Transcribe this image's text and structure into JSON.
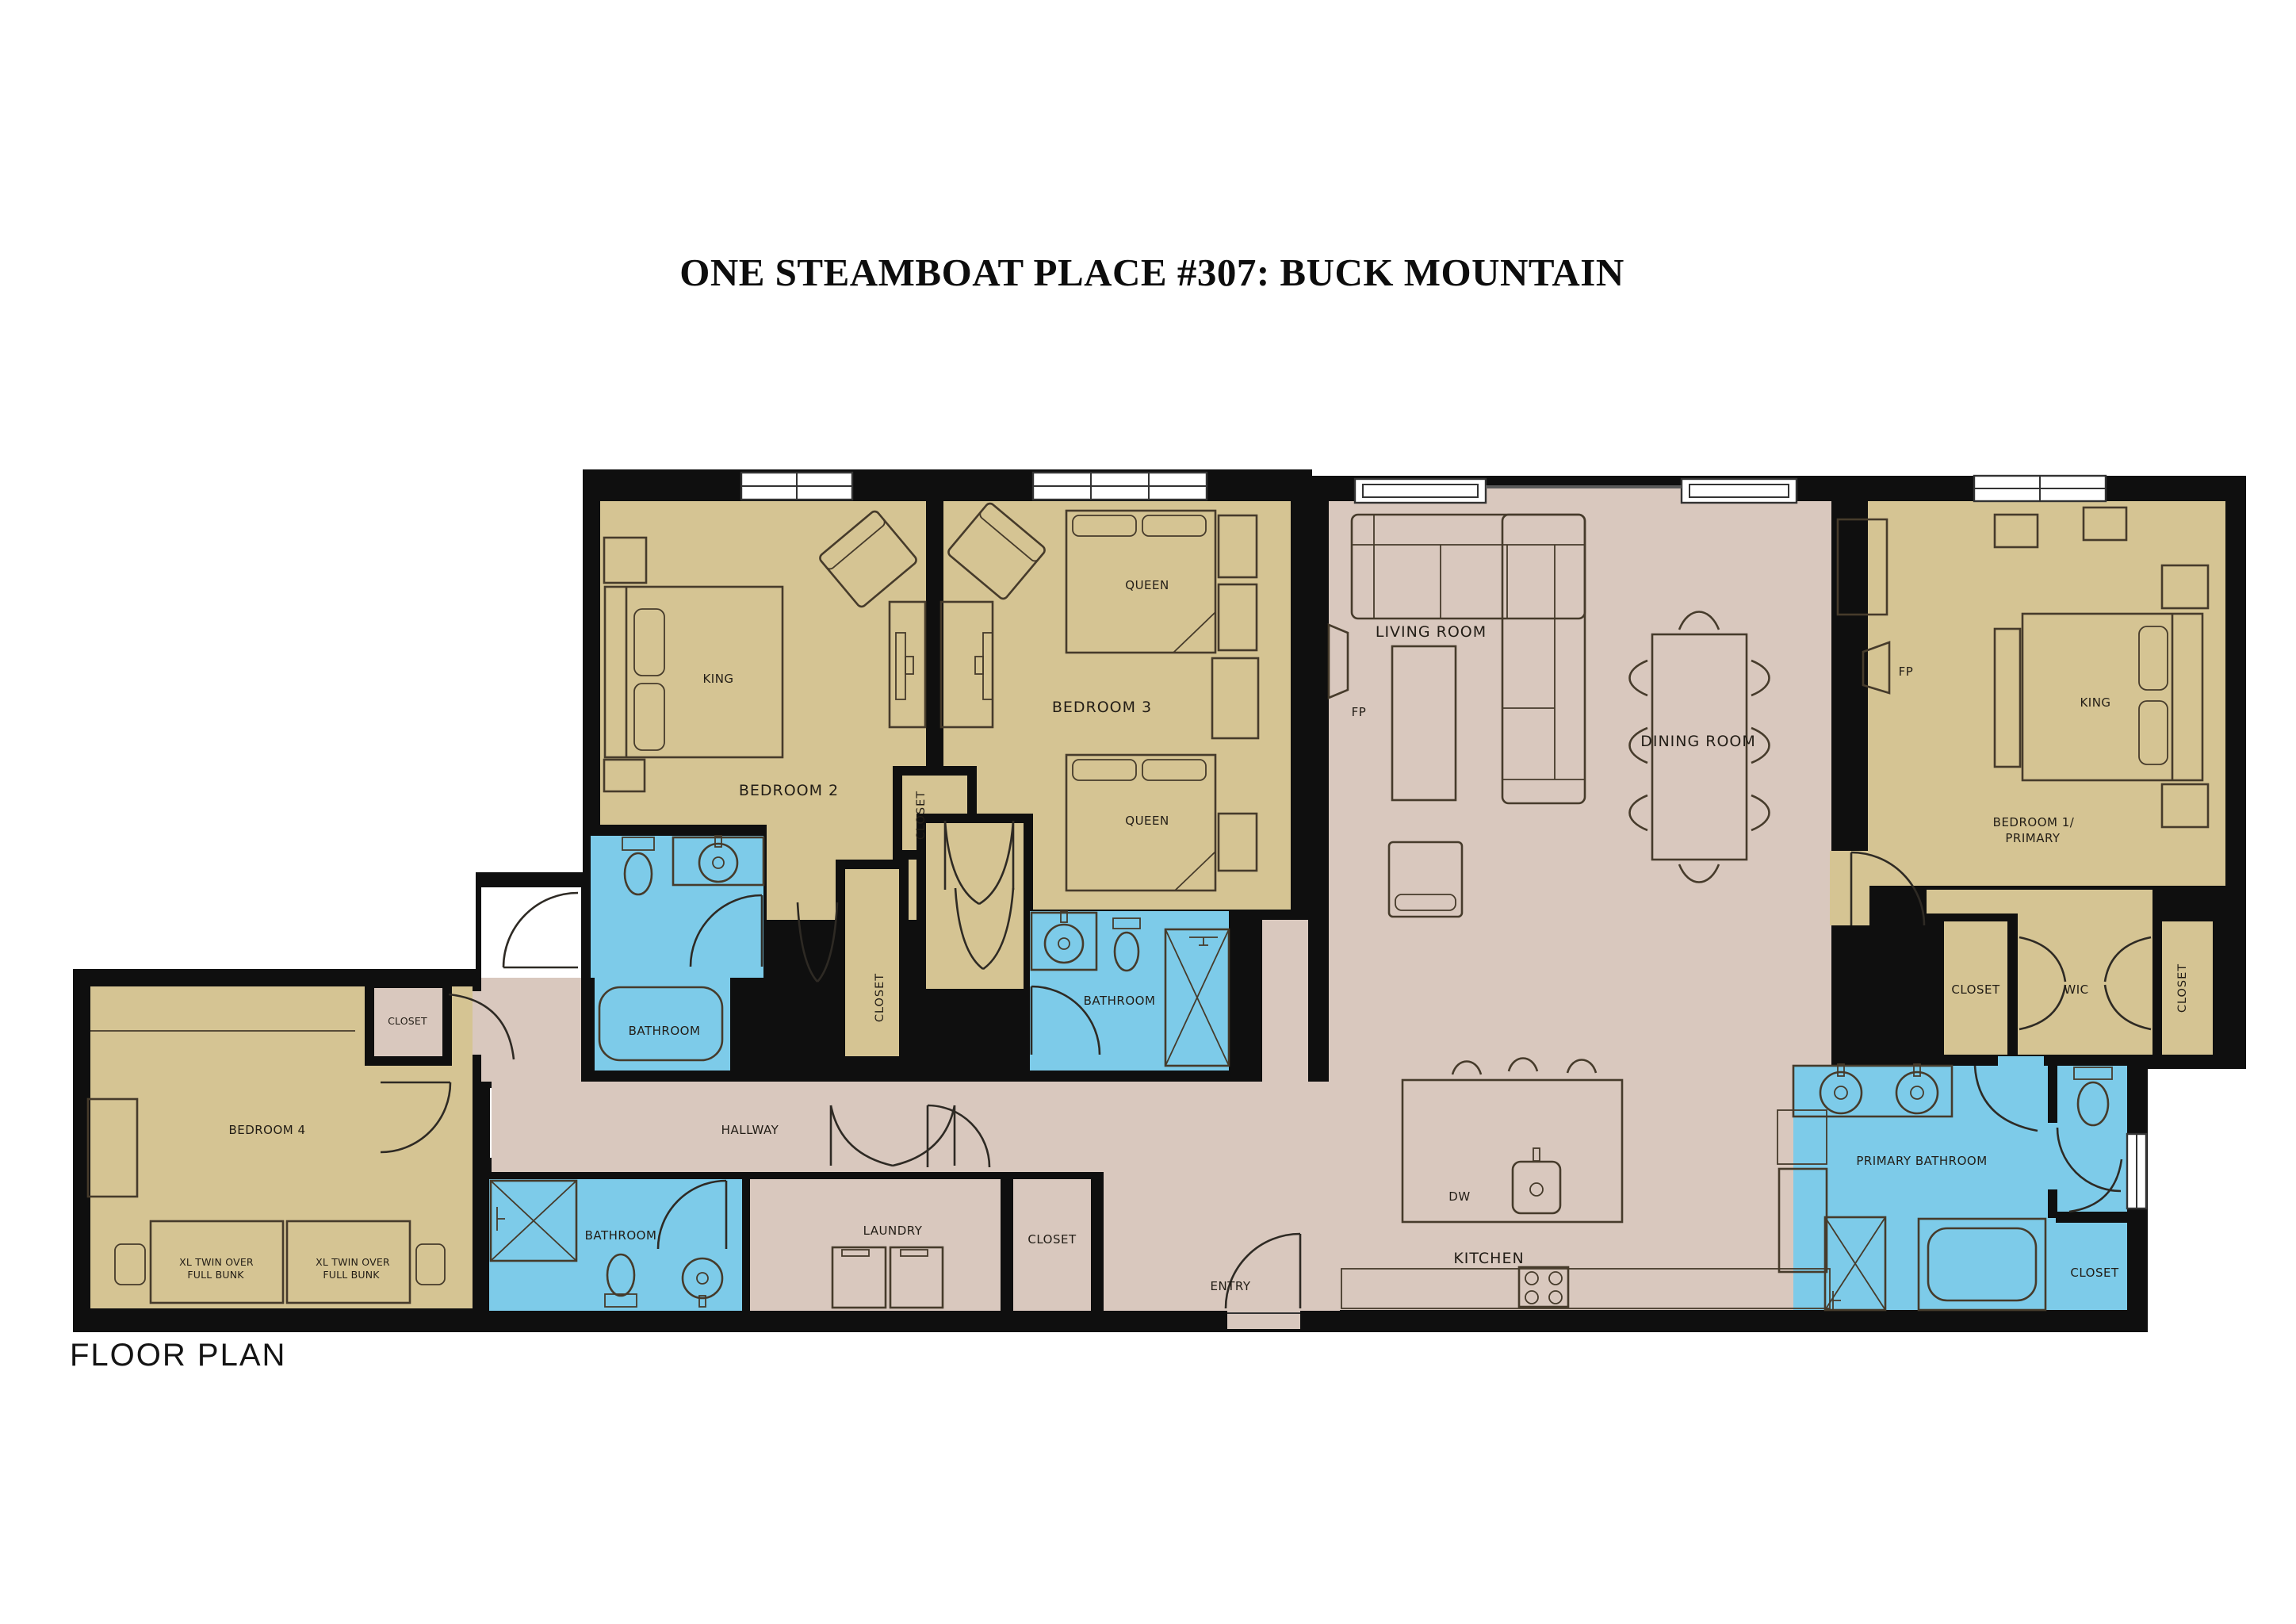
{
  "title": "ONE STEAMBOAT PLACE #307: BUCK MOUNTAIN",
  "caption": "FLOOR PLAN",
  "palette": {
    "bedroom_fill": "#d5c493",
    "common_fill": "#d9c8be",
    "bathroom_fill": "#7dcbe9",
    "wall": "#0f0f0f",
    "background": "#ffffff"
  },
  "rooms": {
    "living": "LIVING ROOM",
    "dining": "DINING ROOM",
    "kitchen": "KITCHEN",
    "hallway": "HALLWAY",
    "laundry": "LAUNDRY",
    "entry": "ENTRY",
    "bedroom1_line1": "BEDROOM 1/",
    "bedroom1_line2": "PRIMARY",
    "bedroom2": "BEDROOM 2",
    "bedroom3": "BEDROOM 3",
    "bedroom4": "BEDROOM 4",
    "primary_bathroom": "PRIMARY BATHROOM",
    "bathroom": "BATHROOM",
    "closet": "CLOSET",
    "wic": "WIC"
  },
  "features": {
    "king": "KING",
    "queen": "QUEEN",
    "dw": "DW",
    "fp": "FP",
    "bunk_line1": "XL TWIN OVER",
    "bunk_line2": "FULL BUNK"
  }
}
